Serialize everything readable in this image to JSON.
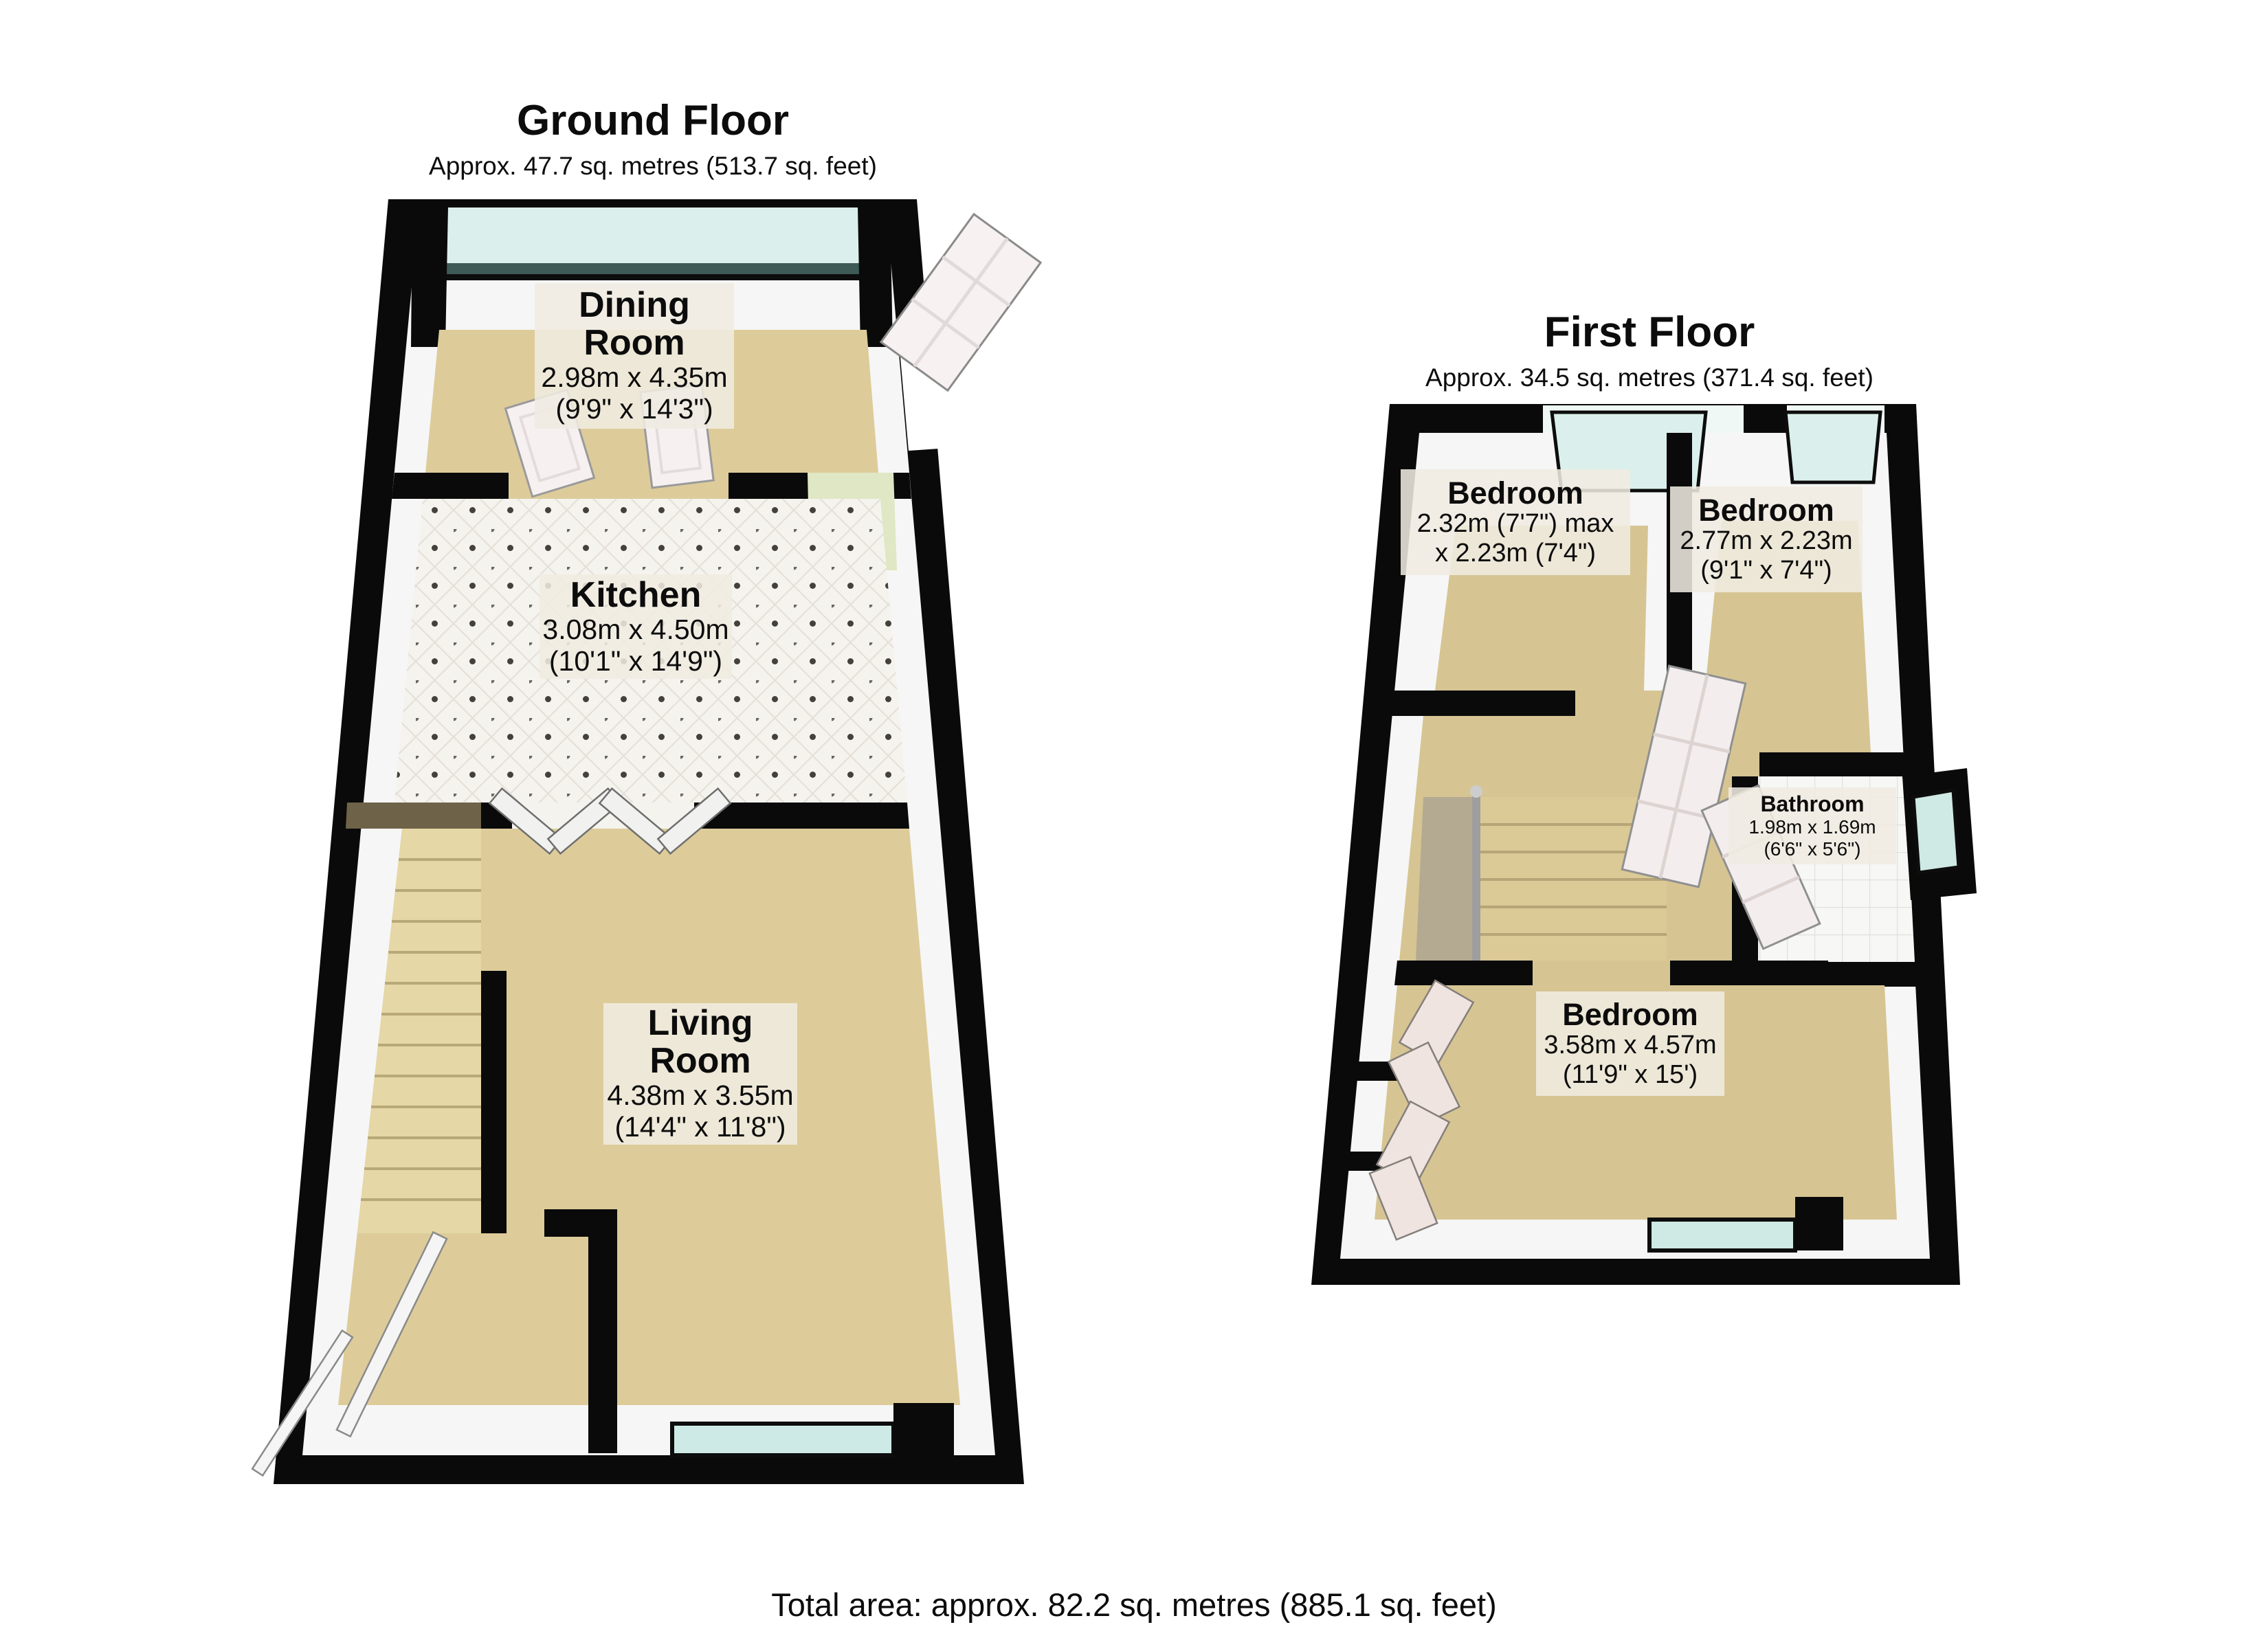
{
  "ground_floor": {
    "title": "Ground Floor",
    "subtitle": "Approx. 47.7 sq. metres (513.7 sq. feet)",
    "rooms": [
      {
        "name": "Dining\nRoom",
        "dims1": "2.98m x 4.35m",
        "dims2": "(9'9\" x 14'3\")"
      },
      {
        "name": "Kitchen",
        "dims1": "3.08m x 4.50m",
        "dims2": "(10'1\" x 14'9\")"
      },
      {
        "name": "Living\nRoom",
        "dims1": "4.38m x 3.55m",
        "dims2": "(14'4\" x 11'8\")"
      }
    ]
  },
  "first_floor": {
    "title": "First Floor",
    "subtitle": "Approx. 34.5 sq. metres (371.4 sq. feet)",
    "rooms": [
      {
        "name": "Bedroom",
        "dims1": "2.32m (7'7\") max",
        "dims2": "x 2.23m (7'4\")"
      },
      {
        "name": "Bedroom",
        "dims1": "2.77m x 2.23m",
        "dims2": "(9'1\" x 7'4\")"
      },
      {
        "name": "Bathroom",
        "dims1": "1.98m x 1.69m",
        "dims2": "(6'6\" x 5'6\")"
      },
      {
        "name": "Bedroom",
        "dims1": "3.58m x 4.57m",
        "dims2": "(11'9\" x 15')"
      }
    ]
  },
  "footer": {
    "total_area": "Total area: approx. 82.2 sq. metres (885.1 sq. feet)"
  },
  "colors": {
    "wall": "#0a0a0a",
    "wall_face": "#f6f6f6",
    "floor_ground": "#ddcc9a",
    "floor_first": "#d6c593",
    "stair": "#e5d7a6",
    "window_glass": "#dbf0ec",
    "window_sill": "#3e5a57",
    "kitchen_tile": "#f5f3ee",
    "accent_green": "#dfe7c4",
    "label_background": "rgba(240,236,225,0.87)"
  }
}
